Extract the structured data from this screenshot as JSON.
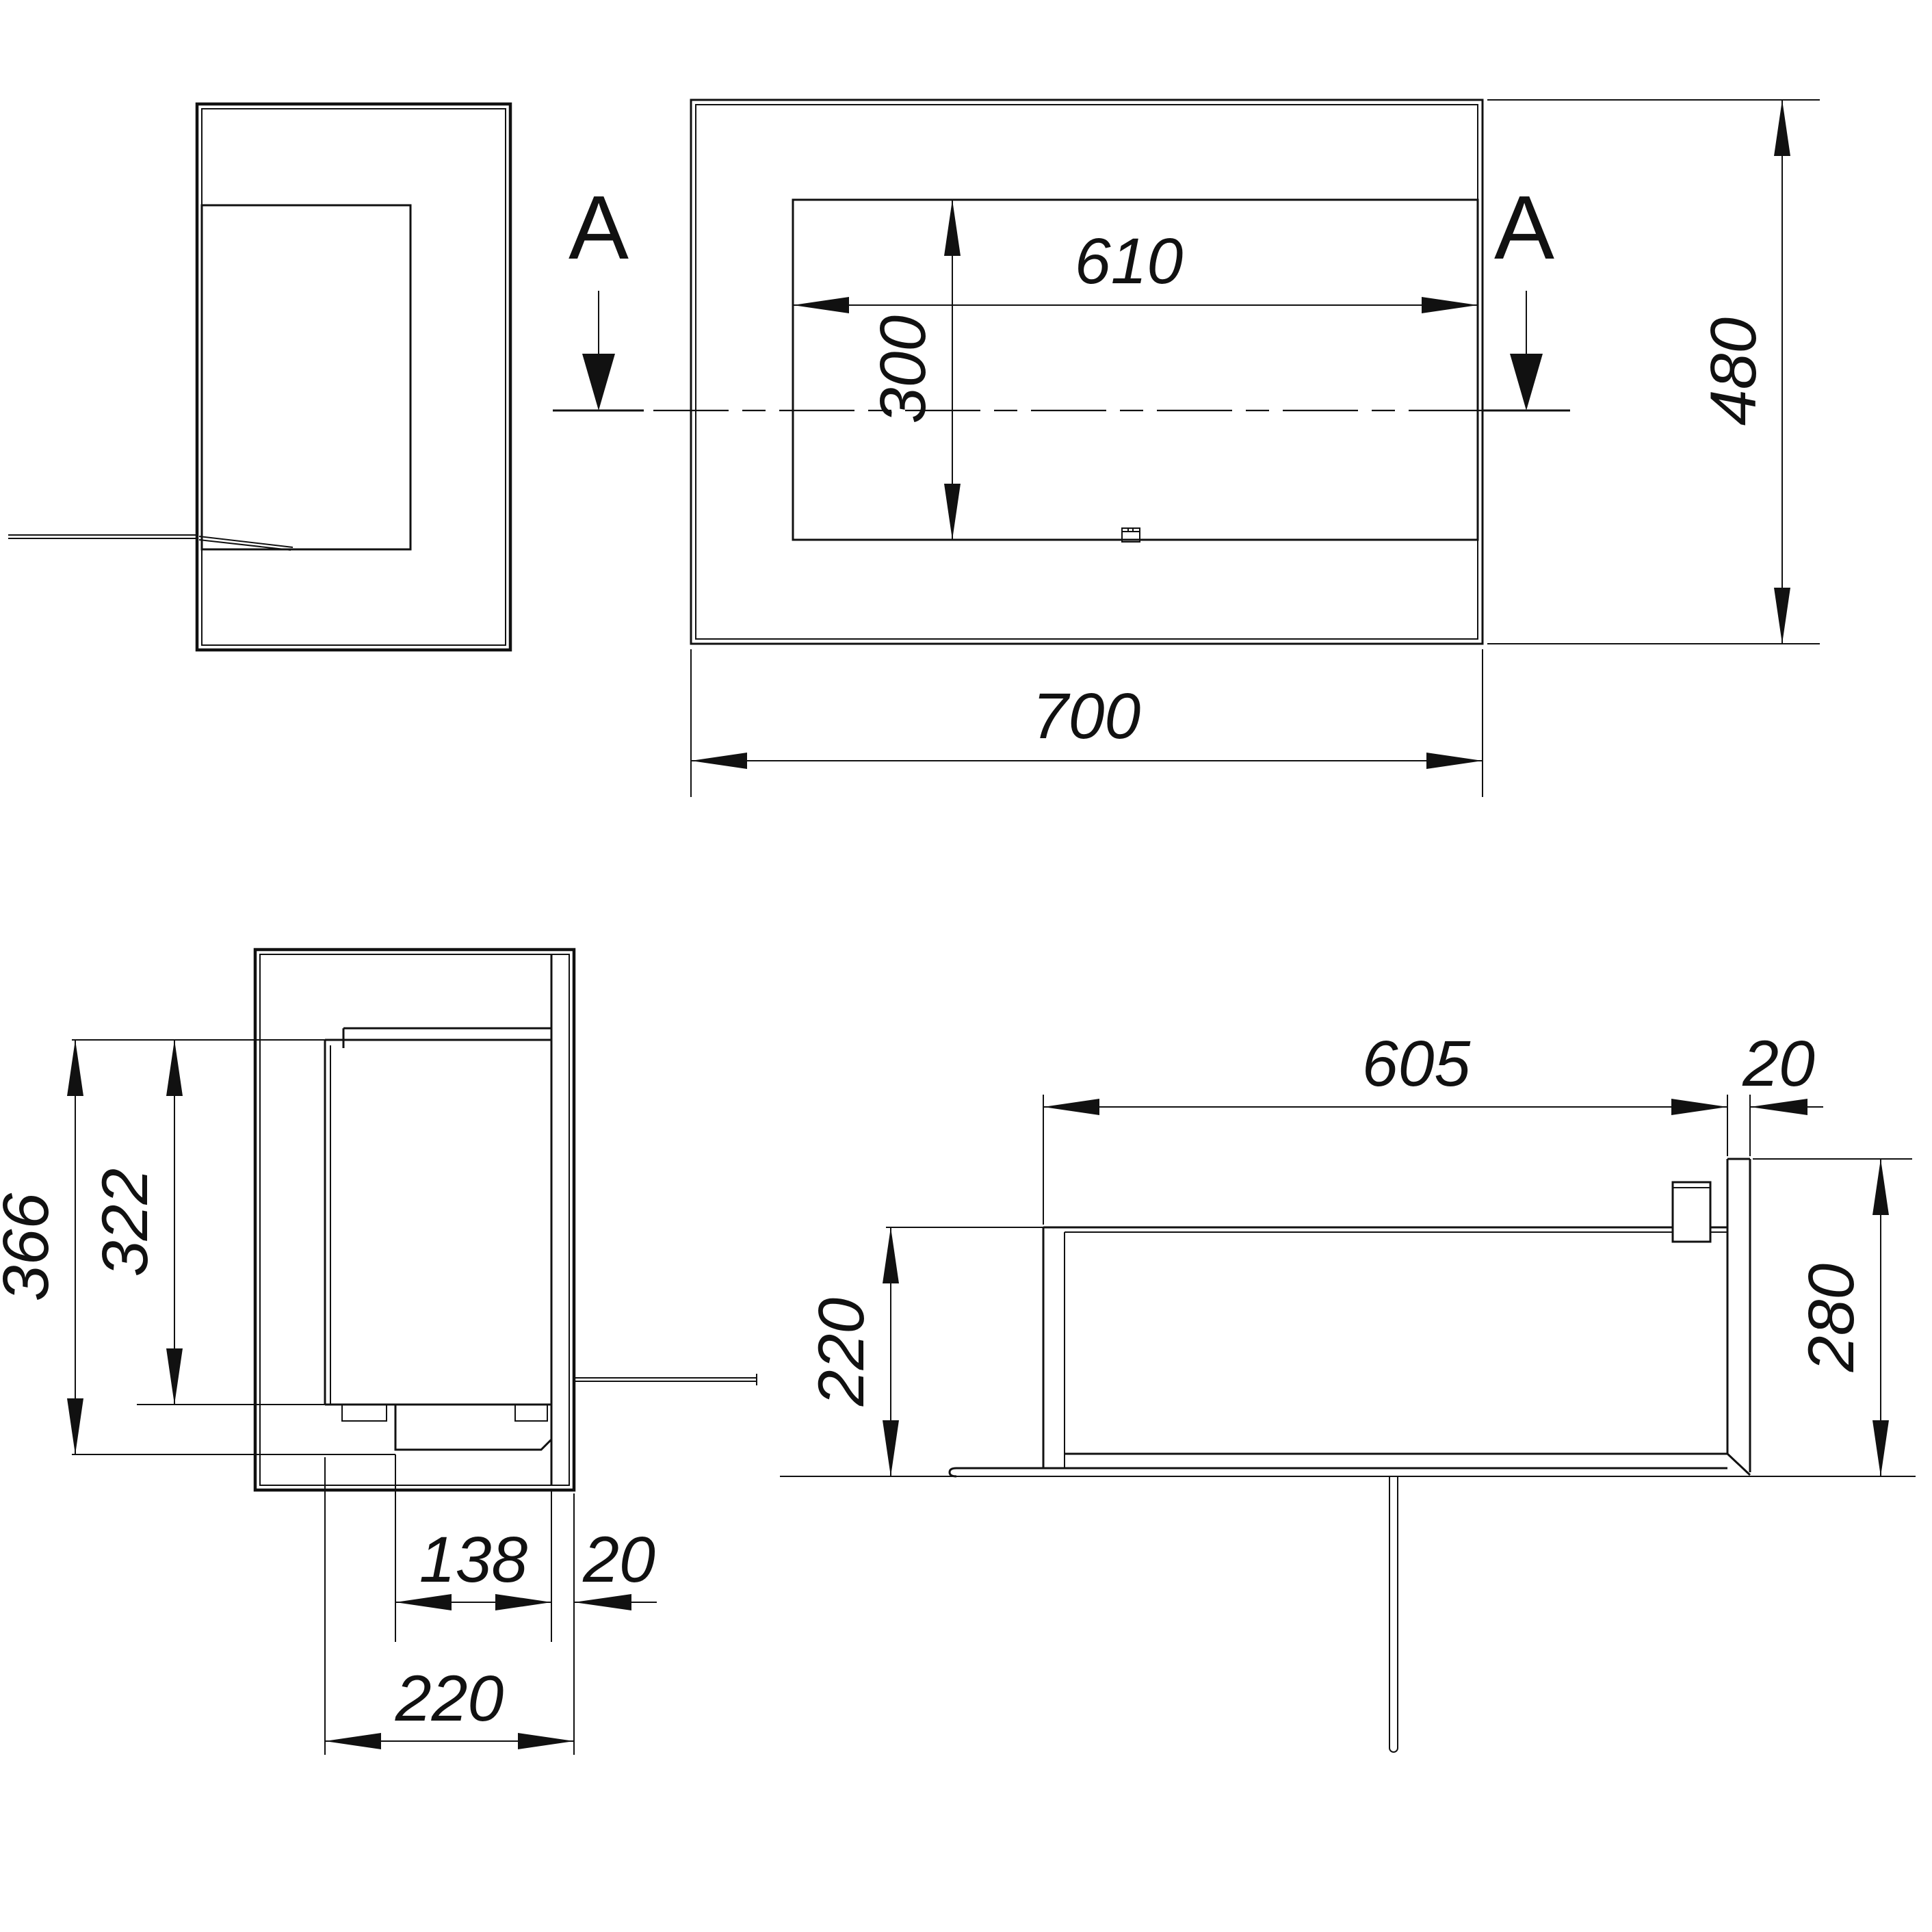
{
  "drawing": {
    "section_label": "A",
    "colors": {
      "background": "#ffffff",
      "line": "#111111"
    },
    "front_view": {
      "opening_width": "610",
      "opening_height": "300",
      "overall_width": "700",
      "overall_height": "480"
    },
    "side_section_view": {
      "total_height": "366",
      "inner_height": "322",
      "tray_width": "138",
      "glass_thickness": "20",
      "depth": "220"
    },
    "top_section_view": {
      "interior_width": "605",
      "glass_thickness": "20",
      "depth": "220",
      "total_depth": "280"
    }
  }
}
